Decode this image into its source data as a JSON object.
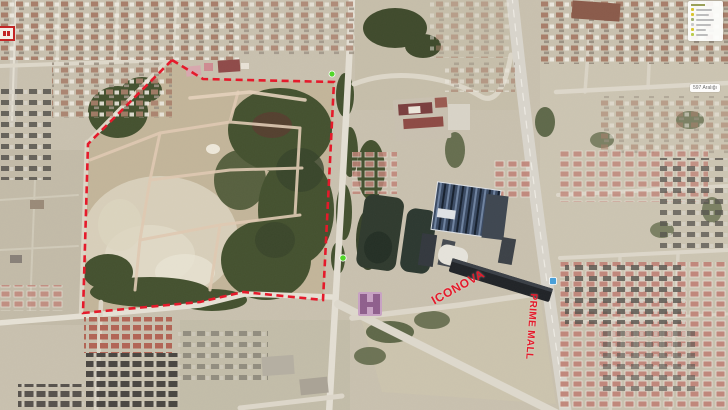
{
  "map": {
    "type": "satellite-aerial-photo",
    "labels": {
      "iconova": "ICONOVA",
      "prime_mall": "PRIME MALL",
      "street": "597 Aralığı"
    },
    "boundary": {
      "color": "#e51a2b",
      "style": "dashed",
      "points": "172,60 203,79 334,82 323,300 243,292 200,302 83,313 88,144"
    },
    "annotation_color": "#e51a2b",
    "markers": [
      {
        "name": "green-poi-marker-top",
        "x": 332,
        "y": 74,
        "color": "#52d62a"
      },
      {
        "name": "green-poi-marker-mid",
        "x": 343,
        "y": 258,
        "color": "#52d62a"
      },
      {
        "name": "blue-poi-marker",
        "x": 553,
        "y": 281,
        "color": "#4aa0d8"
      }
    ],
    "legend": {
      "dot_colors": [
        "#d9c52f",
        "#d9c52f",
        "#9fae71",
        "#c9c9c9",
        "#d9c52f",
        "#b9cc4e"
      ],
      "bar_widths": [
        16,
        13,
        18,
        15,
        10,
        12
      ]
    }
  }
}
